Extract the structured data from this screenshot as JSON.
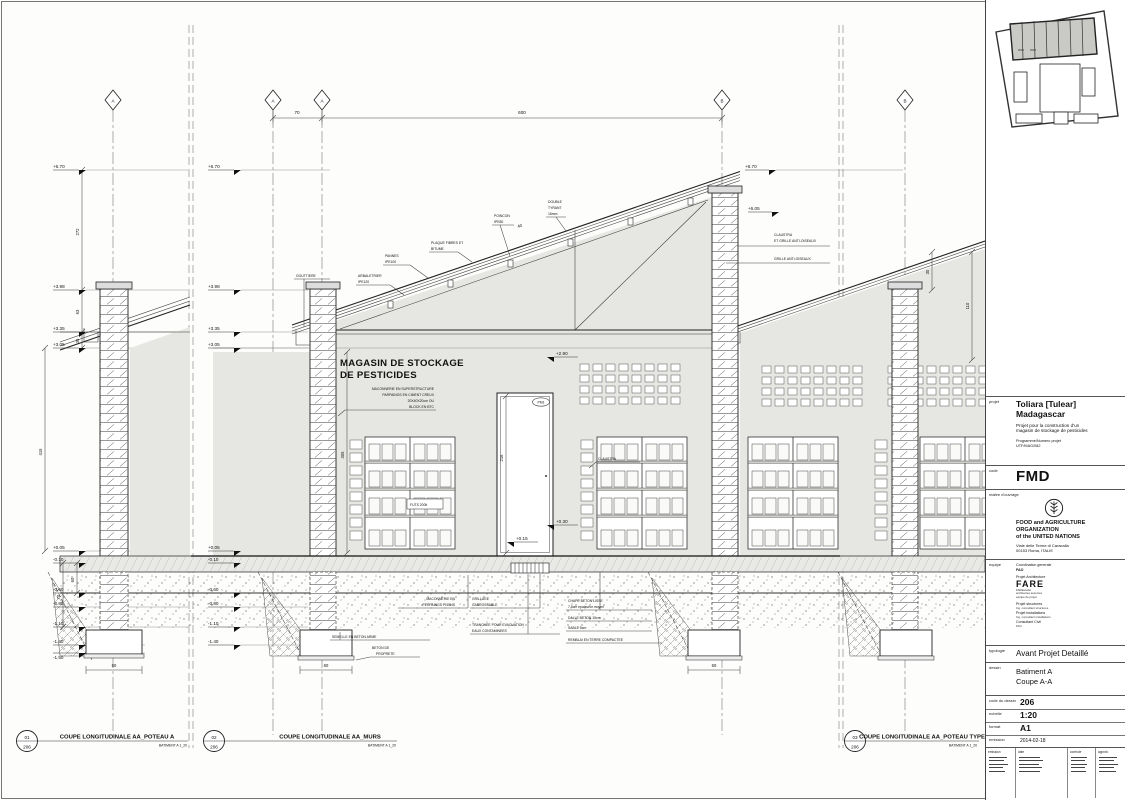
{
  "grid": {
    "a": "A",
    "b": "B"
  },
  "dims": {
    "d70": "70",
    "d600": "600",
    "d272": "272",
    "d63": "63",
    "d30": "30",
    "d415": "415",
    "d60": "60",
    "d70b": "70",
    "d305": "305",
    "d216": "216",
    "d110": "110",
    "d30b": "30",
    "d60f": "60",
    "d40": "40"
  },
  "elev": {
    "e670": "+6.70",
    "e605": "+6.05",
    "e398": "+3.98",
    "e335": "+3.35",
    "e305": "+3.05",
    "e290": "+2.90",
    "e030": "+0.30",
    "e015": "+0.15",
    "e005": "+0.05",
    "em010": "-0.10",
    "em060": "-0.60",
    "em080": "-0.80",
    "em110": "-1.10",
    "em140": "-1.40",
    "em150": "-1.50"
  },
  "ann": {
    "room1": "MAGASIN DE STOCKAGE",
    "room2": "DE PESTICIDES",
    "mac1": "MACONNERIE EN SUPERSTRUCTURE",
    "mac2": "PARPAINGS EN CIMENT CREUX",
    "mac3": "20X40X20cm OU",
    "mac4": "BLOCK EN BTC",
    "poincon1": "POINCON",
    "poincon2": "IPE80",
    "tyrant1": "DOUBLE",
    "tyrant2": "TYRANT",
    "tyrant3": "16mm",
    "plaque1": "PLAQUE FIBRES ET",
    "plaque2": "BITUME",
    "pannes1": "PANNES",
    "pannes2": "IPE100",
    "arba1": "ARBALETRIER",
    "arba2": "IPE120",
    "gouttiere": "GOUTTIERE",
    "claustra_grille1": "CLAUSTRA",
    "claustra_grille2": "ET GRILLE ANTI-OISEAUX",
    "grille": "GRILLE ANTI-OISEAUX",
    "claustra": "CLAUSTRA",
    "futs": "FUTS 200lt",
    "pm1": "PM1",
    "perpaings1": "MACONNERIE EN",
    "perpaings2": "PERPAINGS PLEINS",
    "grillage1": "GRILLAGE",
    "grillage2": "CARROSSABLE",
    "tranchee1": "TRANCHEE POUR EVACUATION",
    "tranchee2": "EAUX CONTAMINEES",
    "chape1": "CHAPE BETON LISSE",
    "chape2": "7.5cm epaisseur moyen",
    "dalle": "DALLE BETON 15cm",
    "sable": "SABLE 5cm",
    "remblai": "REMBLAI EN TERRE COMPACTEE",
    "semelle": "SEMELLE EN BETON ARME",
    "betonprop1": "BETON DE",
    "betonprop2": "PROPRETE"
  },
  "drawings": [
    {
      "num": "01",
      "sheet": "206",
      "title": "COUPE LONGITUDINALE AA_POTEAU A",
      "subtitle": "BATIMENT A 1_20"
    },
    {
      "num": "02",
      "sheet": "206",
      "title": "COUPE LONGITUDINALE AA_MURS",
      "subtitle": "BATIMENT A 1_20"
    },
    {
      "num": "03",
      "sheet": "206",
      "title": "COUPE LONGITUDINALE AA_POTEAU TYPE",
      "subtitle": "BATIMENT A 1_20"
    }
  ],
  "titleblock": {
    "labels": {
      "projet": "projet",
      "code": "code",
      "maitre": "maitre d'ouvrage",
      "equipe": "equipe",
      "typologie": "typologie",
      "dessin": "dessin",
      "code_dessin": "code du dessin",
      "echelle": "echelle",
      "format": "format",
      "emission": "emission"
    },
    "project": {
      "line1": "Toliara [Tulear]",
      "line2": "Madagascar",
      "desc1": "Projet pour la construction d'un",
      "desc2": "magasin de stockage de pesticides",
      "prog_label": "Programme/Numero projet",
      "prog_value": "UTF/MAG/082"
    },
    "code_value": "FMD",
    "client": {
      "org1": "FOOD and AGRICULTURE",
      "org2": "ORGANIZATION",
      "org3": "of the UNITED NATIONS",
      "addr1": "Viale delle Terme di Caracalla",
      "addr2": "00153 Roma, ITALIE"
    },
    "team": {
      "l1": "Coordination generale",
      "l2": "FAO",
      "l3": "Projet Architecture",
      "fare": "FARE",
      "fare_sub": "FAREstudio",
      "names": "architectes associes",
      "names2": "equipe de projet",
      "l4": "Projet structures",
      "l5": "Ing. consultant structures",
      "l6": "Projet installations",
      "l7": "Ing. consultant installations",
      "l8": "Consultant Civil",
      "l9": "FAO"
    },
    "typologie_value": "Avant Projet Detaillé",
    "dessin_line1": "Batiment A",
    "dessin_line2": "Coupe A-A",
    "meta": {
      "code": "206",
      "echelle": "1:20",
      "format": "A1",
      "emission": "2014-02-18"
    },
    "rev_headers": [
      "emission",
      "date",
      "controle",
      "approb."
    ]
  }
}
